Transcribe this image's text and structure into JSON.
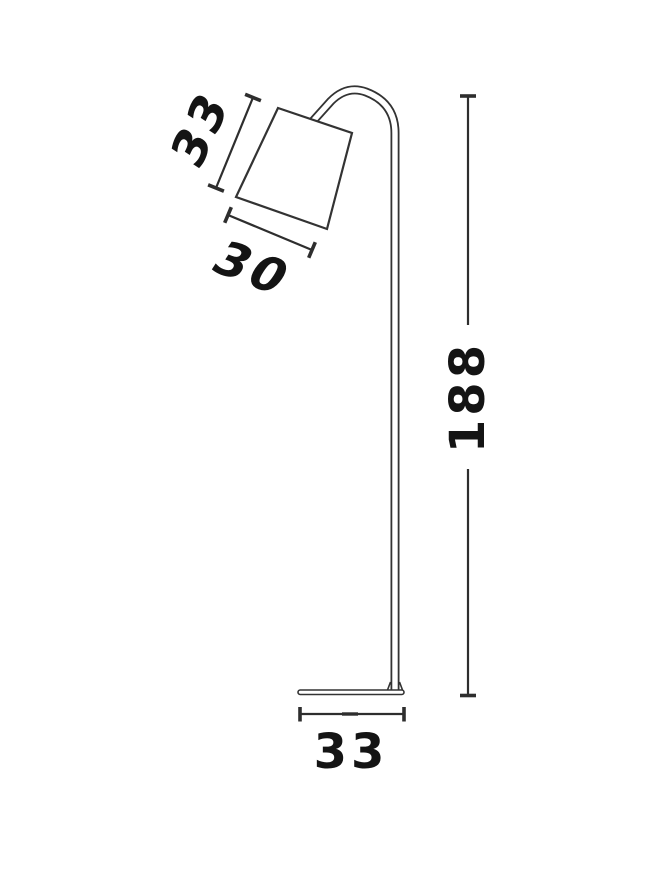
{
  "page": {
    "background": "#ffffff"
  },
  "diagram": {
    "kind": "product-dimension-drawing",
    "subject": "floor-lamp-with-tilted-shade-and-round-base",
    "colors": {
      "line": "#333333",
      "dimension_line": "#2e2e2e",
      "text": "#141414",
      "fill": "#ffffff"
    },
    "dimensions": {
      "shade_slant_height": "33",
      "shade_width": "30",
      "total_height": "188",
      "base_width": "33"
    }
  }
}
